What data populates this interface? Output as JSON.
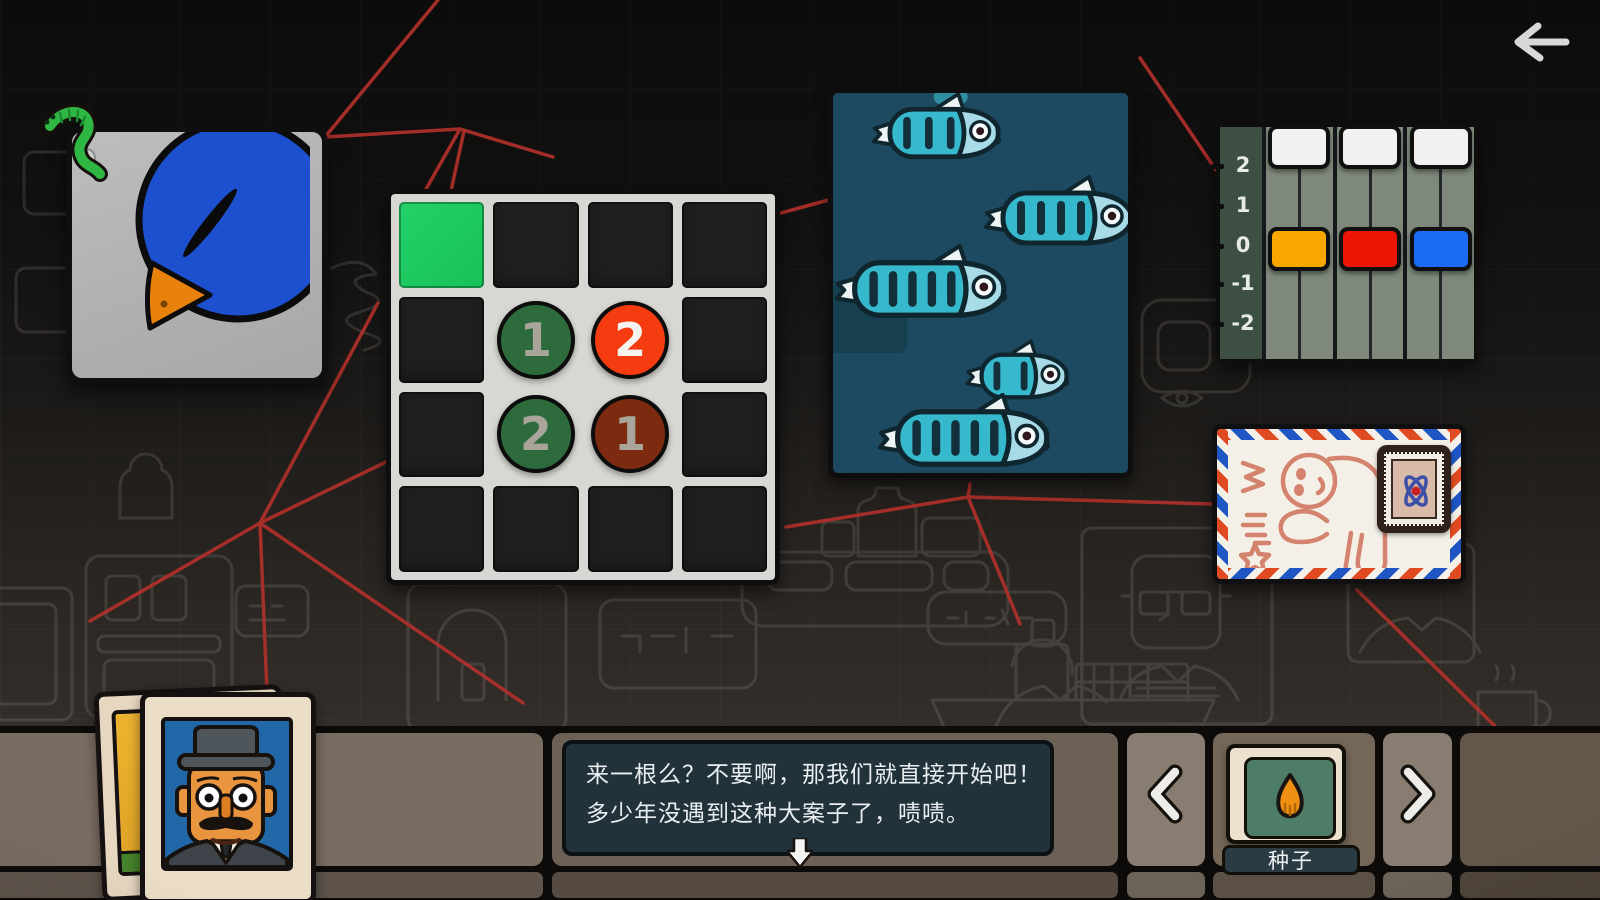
{
  "screen": {
    "back_button": {
      "icon": "left-arrow"
    },
    "string_color": "#b0302a"
  },
  "grid_puzzle": {
    "rows": 4,
    "cols": 4,
    "frame_color": "#d8d7d3",
    "cell_color": "#201e1f",
    "green_cell": {
      "row": 0,
      "col": 0,
      "color": "#17c158"
    },
    "open_cells": [
      [
        1,
        1
      ],
      [
        1,
        2
      ],
      [
        2,
        1
      ],
      [
        2,
        2
      ]
    ],
    "tokens": [
      {
        "row": 1,
        "col": 1,
        "value": "1",
        "bg": "#2d6b3c",
        "fg": "#a9a59b"
      },
      {
        "row": 1,
        "col": 2,
        "value": "2",
        "bg": "#f43c10",
        "fg": "#f6f4f0"
      },
      {
        "row": 2,
        "col": 1,
        "value": "2",
        "bg": "#2d6b3c",
        "fg": "#a9a59b"
      },
      {
        "row": 2,
        "col": 2,
        "value": "1",
        "bg": "#7c2a10",
        "fg": "#a9a59b"
      }
    ]
  },
  "fish_panel": {
    "bg": "#1d4a60",
    "body_color": "#37b9cd",
    "head_color": "#a7dbe7",
    "stripe_color": "#13303a",
    "fin_color": "#eef3f3",
    "fish": [
      {
        "x": 112,
        "y": 40,
        "scale": 0.95,
        "stripes": 3,
        "glow": true
      },
      {
        "x": 242,
        "y": 125,
        "scale": 1.0,
        "stripes": 4
      },
      {
        "x": 112,
        "y": 196,
        "scale": 1.05,
        "stripes": 5
      },
      {
        "x": 186,
        "y": 283,
        "scale": 0.85,
        "stripes": 2
      },
      {
        "x": 155,
        "y": 345,
        "scale": 1.05,
        "stripes": 5
      }
    ]
  },
  "slider_panel": {
    "scale_labels": [
      "2",
      "1",
      "0",
      "-1",
      "-2"
    ],
    "scale_bg": "#3c4f42",
    "track_color": "#7e897b",
    "sliders": [
      {
        "top_color": "#f1f1ef",
        "top_level": 2,
        "value_color": "#f7a700",
        "value_level": 0
      },
      {
        "top_color": "#f1f1ef",
        "top_level": 2,
        "value_color": "#ec1405",
        "value_level": 0
      },
      {
        "top_color": "#f1f1ef",
        "top_level": 2,
        "value_color": "#1b6cf2",
        "value_level": 0
      }
    ]
  },
  "envelope": {
    "stripe_red": "#e04a20",
    "stripe_blue": "#1f56c4",
    "drawing_color": "#d4836e"
  },
  "dialogue": {
    "box_color": "#22323b",
    "lines": [
      "来一根么？不要啊，那我们就直接开始吧！",
      "多少年没遇到这种大案子了，啧啧。"
    ]
  },
  "inventory": {
    "item_label": "种子",
    "prev_icon": "chevron-left",
    "next_icon": "chevron-right",
    "item_icon": "seed"
  }
}
